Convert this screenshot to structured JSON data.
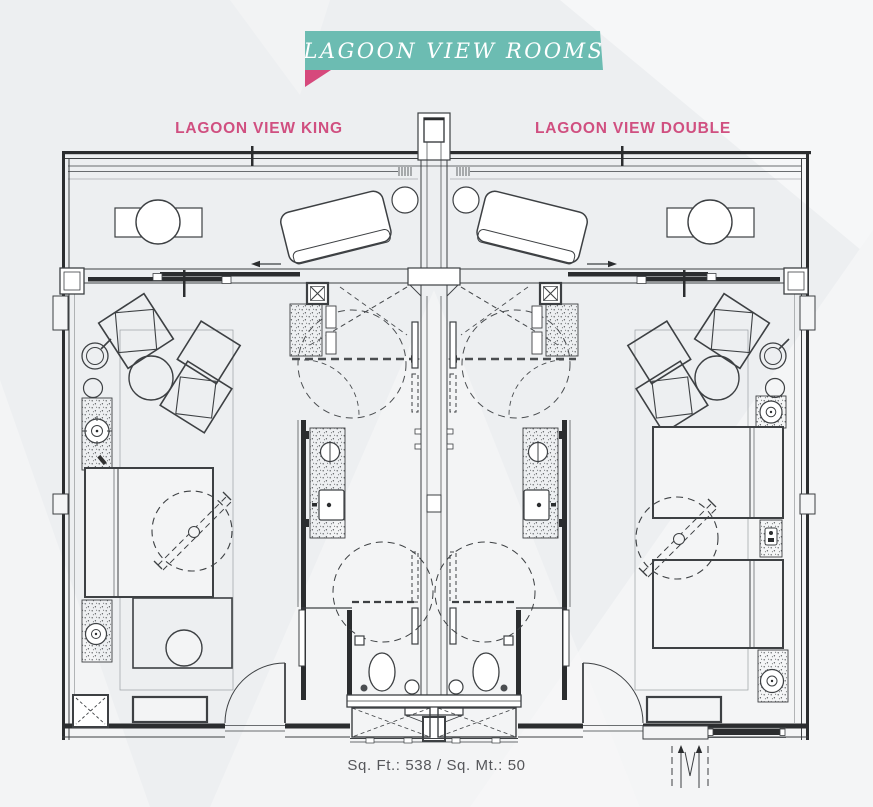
{
  "banner": {
    "text": "LAGOON VIEW ROOMS",
    "background_color": "#6cbcb2",
    "fold_color": "#d6497c",
    "text_color": "#ffffff"
  },
  "room_labels": {
    "king": "LAGOON VIEW KING",
    "double": "LAGOON VIEW DOUBLE",
    "color": "#d04f80"
  },
  "footer": {
    "area_text": "Sq. Ft.: 538 / Sq. Mt.: 50",
    "color": "#55565a"
  },
  "plan": {
    "line_color": "#3d4043",
    "wall_color": "#2b2d2f",
    "rooms": [
      {
        "name": "Lagoon View King",
        "furniture": [
          "king-bed",
          "armchairs",
          "round-table",
          "spiral-lamp",
          "side-stool",
          "console-with-speaker",
          "nightstand-with-speaker",
          "foot-table-with-chair",
          "bench",
          "luggage-rack",
          "entry-door-swing",
          "bathroom-vanity",
          "round-sink",
          "square-sink",
          "shower-circle",
          "toilet",
          "closet",
          "ceiling-feature-circle",
          "balcony-round-table",
          "balcony-chairs",
          "chaise-lounge",
          "balcony-side-table"
        ]
      },
      {
        "name": "Lagoon View Double",
        "furniture": [
          "double-bed-1",
          "double-bed-2",
          "armchairs",
          "round-table",
          "spiral-lamp",
          "side-stool",
          "console-with-speaker",
          "nightstand-with-phone",
          "corner-speaker",
          "bench",
          "entry-door-swing",
          "bathroom-vanity",
          "round-sink",
          "square-sink",
          "shower-circle",
          "toilet",
          "closet",
          "ceiling-feature-circle",
          "balcony-round-table",
          "balcony-chairs",
          "chaise-lounge",
          "balcony-side-table"
        ]
      }
    ],
    "shared_elements": [
      "central-shaft",
      "balcony-railing",
      "sliding-glass-doors",
      "slide-direction-arrows",
      "entry-vestibule",
      "corridor-direction-marks"
    ]
  }
}
